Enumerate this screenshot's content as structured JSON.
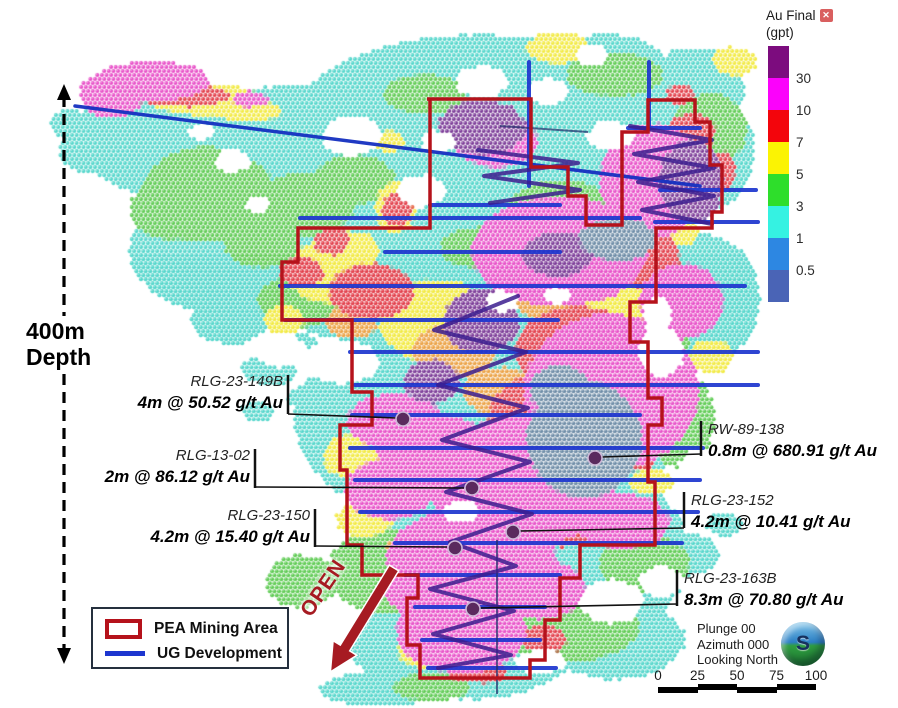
{
  "legend_scale": {
    "title": "Au Final",
    "unit": "(gpt)",
    "close_icon": "✕",
    "bands": [
      {
        "color": "#7c0c7e",
        "label": "30"
      },
      {
        "color": "#fb02fb",
        "label": "10"
      },
      {
        "color": "#f3050c",
        "label": "7"
      },
      {
        "color": "#fbf303",
        "label": "5"
      },
      {
        "color": "#2ede2b",
        "label": "3"
      },
      {
        "color": "#35f2e2",
        "label": "1"
      },
      {
        "color": "#2d87e2",
        "label": "0.5"
      },
      {
        "color": "#4a64b6",
        "label": ""
      }
    ]
  },
  "depth": {
    "line1": "400m",
    "line2": "Depth"
  },
  "open_label": "OPEN",
  "map_legend": {
    "area_label": "PEA Mining Area",
    "line_label": "UG Development",
    "area_color": "#b5121b",
    "line_color": "#1d36cf"
  },
  "view_info": {
    "lines": [
      "Plunge 00",
      "Azimuth 000",
      "Looking North"
    ],
    "ball_letter": "S"
  },
  "scale_bar": {
    "labels": [
      "0",
      "25",
      "50",
      "75",
      "100"
    ]
  },
  "callouts": [
    {
      "name": "RLG-23-149B",
      "grade": "4m @ 50.52 g/t Au",
      "side": "left",
      "text_x": 283,
      "text_y": 371,
      "tick_x": 288,
      "tick_y1": 375,
      "tick_y2": 414,
      "lx1": 288,
      "ly1": 414,
      "lx2": 397,
      "ly2": 418,
      "mx": 403,
      "my": 419
    },
    {
      "name": "RLG-13-02",
      "grade": "2m @ 86.12 g/t Au",
      "side": "left",
      "text_x": 250,
      "text_y": 445,
      "tick_x": 255,
      "tick_y1": 449,
      "tick_y2": 488,
      "lx1": 255,
      "ly1": 487,
      "lx2": 464,
      "ly2": 488,
      "mx": 472,
      "my": 488
    },
    {
      "name": "RLG-23-150",
      "grade": "4.2m @ 15.40 g/t Au",
      "side": "left",
      "text_x": 310,
      "text_y": 505,
      "tick_x": 315,
      "tick_y1": 509,
      "tick_y2": 547,
      "lx1": 315,
      "ly1": 546,
      "lx2": 447,
      "ly2": 547,
      "mx": 455,
      "my": 548
    },
    {
      "name": "RW-89-138",
      "grade": "0.8m @ 680.91 g/t Au",
      "side": "right",
      "text_x": 708,
      "text_y": 419,
      "tick_x": 701,
      "tick_y1": 421,
      "tick_y2": 456,
      "lx1": 602,
      "ly1": 457,
      "lx2": 701,
      "ly2": 454,
      "mx": 595,
      "my": 458
    },
    {
      "name": "RLG-23-152",
      "grade": "4.2m @ 10.41 g/t Au",
      "side": "right",
      "text_x": 691,
      "text_y": 490,
      "tick_x": 684,
      "tick_y1": 492,
      "tick_y2": 528,
      "lx1": 520,
      "ly1": 531,
      "lx2": 684,
      "ly2": 528,
      "mx": 513,
      "my": 532
    },
    {
      "name": "RLG-23-163B",
      "grade": "8.3m @ 70.80 g/t Au",
      "side": "right",
      "text_x": 684,
      "text_y": 568,
      "tick_x": 677,
      "tick_y1": 570,
      "tick_y2": 606,
      "lx1": 480,
      "ly1": 608,
      "lx2": 677,
      "ly2": 604,
      "mx": 473,
      "my": 609
    }
  ],
  "overlays": {
    "pea_color": "#b5121b",
    "ug_color": "#1d36cf",
    "decline_color": "#3c1d8e",
    "marker_color": "#5a2a5e",
    "pea_path": "M427,99 H531 V167 H568 V196 H586 V225 H622 V132 H648 V100 H695 V122 H710 V165 H722 V212 H712 V228 H656 V302 H630 V342 H648 V398 H662 V425 H648 V482 H655 V545 H580 V578 H560 V620 H545 V660 H530 V678 H420 V645 H407 V598 H418 V575 H362 V545 H347 V470 H340 V425 H372 V392 H352 V320 H282 V262 H298 V228 H430 V99 Z",
    "long_line": [
      75,
      106,
      700,
      186
    ],
    "ug_lines": [
      [
        300,
        218,
        640,
        218
      ],
      [
        385,
        252,
        560,
        252
      ],
      [
        280,
        286,
        745,
        286
      ],
      [
        285,
        320,
        558,
        320
      ],
      [
        350,
        352,
        758,
        352
      ],
      [
        355,
        385,
        758,
        385
      ],
      [
        352,
        415,
        640,
        415
      ],
      [
        350,
        448,
        703,
        448
      ],
      [
        355,
        480,
        700,
        480
      ],
      [
        360,
        512,
        698,
        512
      ],
      [
        395,
        543,
        682,
        543
      ],
      [
        405,
        575,
        560,
        575
      ],
      [
        415,
        607,
        545,
        607
      ],
      [
        422,
        640,
        540,
        640
      ],
      [
        428,
        668,
        556,
        668
      ],
      [
        628,
        128,
        700,
        128
      ],
      [
        660,
        190,
        756,
        190
      ],
      [
        655,
        222,
        758,
        222
      ],
      [
        430,
        205,
        560,
        205
      ],
      [
        529,
        62,
        529,
        186
      ],
      [
        649,
        62,
        649,
        128
      ]
    ],
    "dark_lines": [
      [
        500,
        126,
        588,
        132
      ],
      [
        497,
        540,
        497,
        694
      ]
    ],
    "declines": [
      "M478,150 L578,163 L484,176 L580,190 L490,203",
      "M630,126 L712,140 L634,154 L714,168 L638,182 L714,196 L642,210 L712,224",
      "M518,296 L434,330 L526,352 L438,385 L528,408 L442,440 L530,462 L446,492 L532,514 L450,542",
      "M450,542 L516,566 L430,589 L514,611 L433,634 L511,655 L438,668"
    ],
    "open_arrow_path": "M389.3,565.1 L398.7,570.9 L349.7,650.9 L356.9,655.3 L330.4,671.9 L333.1,640.7 L340.3,645.1 Z",
    "depth_axis": {
      "x": 64,
      "seg1": [
        96,
        316
      ],
      "seg2": [
        374,
        652
      ],
      "tip_top": 84,
      "tip_bottom": 664
    }
  },
  "heatmap": {
    "spacing": 4.6,
    "dot_radius": 2.05,
    "blobs": [
      [
        160,
        135,
        85,
        60,
        "#53d6cb"
      ],
      [
        300,
        170,
        160,
        85,
        "#53d6cb"
      ],
      [
        250,
        250,
        120,
        70,
        "#53d6cb"
      ],
      [
        480,
        120,
        185,
        85,
        "#53d6cb"
      ],
      [
        660,
        150,
        95,
        80,
        "#53d6cb"
      ],
      [
        430,
        255,
        150,
        75,
        "#53d6cb"
      ],
      [
        560,
        300,
        175,
        105,
        "#53d6cb"
      ],
      [
        490,
        420,
        195,
        115,
        "#53d6cb"
      ],
      [
        530,
        555,
        160,
        105,
        "#53d6cb"
      ],
      [
        465,
        645,
        115,
        55,
        "#53d6cb"
      ],
      [
        705,
        300,
        55,
        65,
        "#53d6cb"
      ],
      [
        695,
        90,
        50,
        42,
        "#53d6cb"
      ],
      [
        605,
        65,
        60,
        30,
        "#53d6cb"
      ],
      [
        345,
        300,
        60,
        40,
        "#53d6cb"
      ],
      [
        230,
        320,
        40,
        25,
        "#53d6cb"
      ],
      [
        95,
        150,
        35,
        25,
        "#53d6cb"
      ],
      [
        70,
        125,
        20,
        15,
        "#53d6cb"
      ],
      [
        615,
        640,
        70,
        40,
        "#53d6cb"
      ],
      [
        270,
        370,
        28,
        16,
        "#53d6cb"
      ],
      [
        310,
        398,
        22,
        13,
        "#53d6cb"
      ],
      [
        258,
        412,
        16,
        10,
        "#53d6cb"
      ],
      [
        302,
        347,
        18,
        11,
        "#53d6cb"
      ],
      [
        332,
        422,
        22,
        12,
        "#53d6cb"
      ],
      [
        356,
        392,
        18,
        10,
        "#53d6cb"
      ],
      [
        685,
        555,
        35,
        22,
        "#53d6cb"
      ],
      [
        725,
        525,
        18,
        12,
        "#53d6cb"
      ],
      [
        380,
        690,
        60,
        18,
        "#53d6cb"
      ],
      [
        205,
        195,
        62,
        48,
        "#5ecb53"
      ],
      [
        305,
        205,
        50,
        32,
        "#5ecb53"
      ],
      [
        262,
        242,
        38,
        26,
        "#5ecb53"
      ],
      [
        425,
        95,
        42,
        20,
        "#5ecb53"
      ],
      [
        615,
        75,
        48,
        22,
        "#5ecb53"
      ],
      [
        710,
        130,
        38,
        36,
        "#5ecb53"
      ],
      [
        560,
        205,
        48,
        24,
        "#5ecb53"
      ],
      [
        478,
        248,
        38,
        20,
        "#5ecb53"
      ],
      [
        300,
        302,
        42,
        26,
        "#5ecb53"
      ],
      [
        622,
        302,
        55,
        38,
        "#5ecb53"
      ],
      [
        680,
        420,
        35,
        48,
        "#5ecb53"
      ],
      [
        385,
        572,
        58,
        42,
        "#5ecb53"
      ],
      [
        302,
        582,
        36,
        26,
        "#5ecb53"
      ],
      [
        565,
        625,
        75,
        38,
        "#5ecb53"
      ],
      [
        645,
        565,
        45,
        30,
        "#5ecb53"
      ],
      [
        432,
        688,
        38,
        14,
        "#5ecb53"
      ],
      [
        170,
        210,
        40,
        30,
        "#5ecb53"
      ],
      [
        240,
        180,
        30,
        20,
        "#5ecb53"
      ],
      [
        355,
        180,
        40,
        25,
        "#5ecb53"
      ],
      [
        672,
        330,
        20,
        30,
        "#5ecb53"
      ],
      [
        205,
        100,
        58,
        16,
        "#f2ea41"
      ],
      [
        248,
        112,
        35,
        11,
        "#f2ea41"
      ],
      [
        390,
        142,
        15,
        11,
        "#f2ea41"
      ],
      [
        396,
        208,
        20,
        26,
        "#f2ea41"
      ],
      [
        508,
        147,
        13,
        11,
        "#f2ea41"
      ],
      [
        558,
        48,
        32,
        16,
        "#f2ea41"
      ],
      [
        735,
        62,
        22,
        15,
        "#f2ea41"
      ],
      [
        332,
        272,
        45,
        32,
        "#f2ea41"
      ],
      [
        352,
        250,
        28,
        18,
        "#f2ea41"
      ],
      [
        523,
        242,
        22,
        16,
        "#f2ea41"
      ],
      [
        438,
        322,
        58,
        42,
        "#f2ea41"
      ],
      [
        625,
        332,
        48,
        36,
        "#f2ea41"
      ],
      [
        712,
        357,
        22,
        17,
        "#f2ea41"
      ],
      [
        382,
        472,
        32,
        22,
        "#f2ea41"
      ],
      [
        348,
        457,
        24,
        22,
        "#f2ea41"
      ],
      [
        424,
        652,
        26,
        16,
        "#f2ea41"
      ],
      [
        652,
        482,
        22,
        13,
        "#f2ea41"
      ],
      [
        600,
        305,
        45,
        32,
        "#f2ea41"
      ],
      [
        285,
        320,
        20,
        15,
        "#f2ea41"
      ],
      [
        365,
        520,
        28,
        18,
        "#f2ea41"
      ],
      [
        678,
        232,
        22,
        14,
        "#f2ea41"
      ],
      [
        455,
        352,
        42,
        28,
        "#eba143"
      ],
      [
        502,
        392,
        38,
        24,
        "#eba143"
      ],
      [
        412,
        552,
        26,
        18,
        "#eba143"
      ],
      [
        602,
        470,
        26,
        17,
        "#eba143"
      ],
      [
        352,
        322,
        26,
        17,
        "#eba143"
      ],
      [
        545,
        300,
        30,
        20,
        "#eba143"
      ],
      [
        182,
        96,
        48,
        11,
        "#e23d49"
      ],
      [
        398,
        210,
        15,
        18,
        "#e23d49"
      ],
      [
        512,
        150,
        8,
        8,
        "#e23d49"
      ],
      [
        372,
        292,
        42,
        28,
        "#e23d49"
      ],
      [
        332,
        242,
        18,
        13,
        "#e23d49"
      ],
      [
        578,
        352,
        62,
        45,
        "#e23d49"
      ],
      [
        532,
        432,
        45,
        55,
        "#e23d49"
      ],
      [
        562,
        522,
        38,
        26,
        "#e23d49"
      ],
      [
        482,
        562,
        32,
        22,
        "#e23d49"
      ],
      [
        432,
        602,
        22,
        15,
        "#e23d49"
      ],
      [
        652,
        262,
        28,
        32,
        "#e23d49"
      ],
      [
        692,
        132,
        24,
        18,
        "#e23d49"
      ],
      [
        642,
        442,
        22,
        28,
        "#e23d49"
      ],
      [
        302,
        272,
        22,
        15,
        "#e23d49"
      ],
      [
        545,
        640,
        22,
        14,
        "#e23d49"
      ],
      [
        478,
        672,
        30,
        12,
        "#e23d49"
      ],
      [
        722,
        172,
        14,
        20,
        "#e23d49"
      ],
      [
        680,
        95,
        14,
        10,
        "#e23d49"
      ],
      [
        152,
        82,
        58,
        20,
        "#e84fc8"
      ],
      [
        112,
        95,
        32,
        24,
        "#e84fc8"
      ],
      [
        250,
        100,
        18,
        8,
        "#e84fc8"
      ],
      [
        560,
        252,
        88,
        55,
        "#e84fc8"
      ],
      [
        612,
        392,
        88,
        78,
        "#e84fc8"
      ],
      [
        522,
        482,
        95,
        65,
        "#e84fc8"
      ],
      [
        472,
        562,
        85,
        55,
        "#e84fc8"
      ],
      [
        462,
        632,
        65,
        42,
        "#e84fc8"
      ],
      [
        652,
        182,
        52,
        58,
        "#e84fc8"
      ],
      [
        682,
        302,
        42,
        38,
        "#e84fc8"
      ],
      [
        622,
        522,
        48,
        28,
        "#e84fc8"
      ],
      [
        435,
        452,
        58,
        38,
        "#e84fc8"
      ],
      [
        395,
        422,
        48,
        28,
        "#e84fc8"
      ],
      [
        497,
        142,
        42,
        26,
        "#e84fc8"
      ],
      [
        432,
        585,
        50,
        35,
        "#e84fc8"
      ],
      [
        540,
        590,
        45,
        30,
        "#e84fc8"
      ],
      [
        390,
        490,
        45,
        30,
        "#e84fc8"
      ],
      [
        482,
        128,
        44,
        28,
        "#7b3a97"
      ],
      [
        692,
        182,
        32,
        42,
        "#7b3a97"
      ],
      [
        482,
        322,
        38,
        32,
        "#7b3a97"
      ],
      [
        432,
        382,
        28,
        22,
        "#7b3a97"
      ],
      [
        558,
        255,
        35,
        22,
        "#7b3a97"
      ],
      [
        585,
        440,
        58,
        58,
        "#6b8aa5"
      ],
      [
        618,
        240,
        38,
        22,
        "#6b8aa5"
      ],
      [
        560,
        390,
        30,
        25,
        "#6b8aa5"
      ]
    ],
    "holes": [
      [
        352,
        136,
        30,
        20
      ],
      [
        482,
        82,
        26,
        16
      ],
      [
        548,
        92,
        20,
        13
      ],
      [
        612,
        136,
        24,
        14
      ],
      [
        232,
        162,
        18,
        12
      ],
      [
        502,
        302,
        16,
        11
      ],
      [
        558,
        296,
        13,
        9
      ],
      [
        462,
        512,
        18,
        11
      ],
      [
        612,
        602,
        32,
        22
      ],
      [
        662,
        582,
        22,
        15
      ],
      [
        342,
        362,
        38,
        22
      ],
      [
        282,
        352,
        26,
        16
      ],
      [
        422,
        192,
        24,
        16
      ],
      [
        662,
        352,
        22,
        26
      ],
      [
        702,
        482,
        26,
        34
      ],
      [
        542,
        662,
        26,
        12
      ],
      [
        202,
        132,
        13,
        9
      ],
      [
        592,
        56,
        16,
        11
      ],
      [
        438,
        142,
        16,
        11
      ],
      [
        258,
        205,
        12,
        8
      ],
      [
        658,
        315,
        14,
        18
      ]
    ]
  }
}
